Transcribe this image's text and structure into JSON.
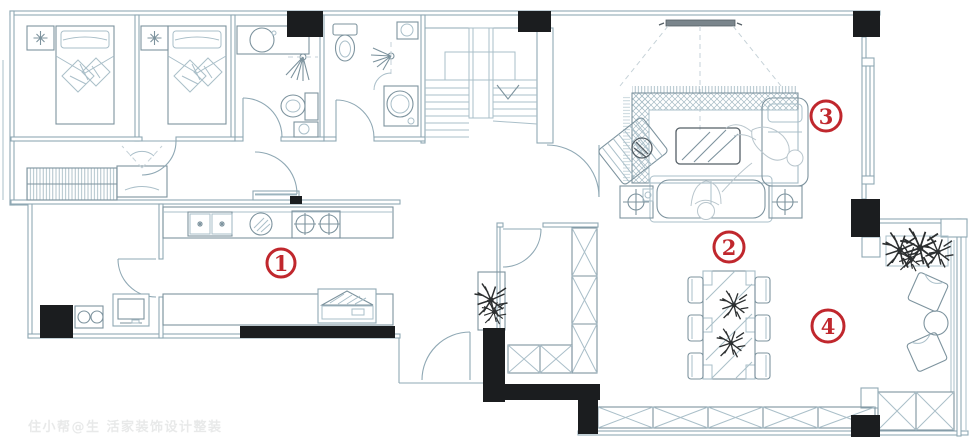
{
  "colors": {
    "wall": "#8fa8b4",
    "furn": "#aabfc9",
    "furnd": "#7d939e",
    "dark": "#555f66",
    "black": "#1b1d1f",
    "red": "#c0272d",
    "dashc": "#c6d2d8",
    "people": "#b9c6cd",
    "plantc": "#2c2f30",
    "wm": "#c4c8c8"
  },
  "markers": [
    {
      "number": "1",
      "area": "kitchen-dining"
    },
    {
      "number": "2",
      "area": "dining-table-zone"
    },
    {
      "number": "3",
      "area": "living-room"
    },
    {
      "number": "4",
      "area": "leisure-balcony"
    }
  ],
  "watermark": {
    "text": "住小帮@生 活家装饰设计整装"
  }
}
